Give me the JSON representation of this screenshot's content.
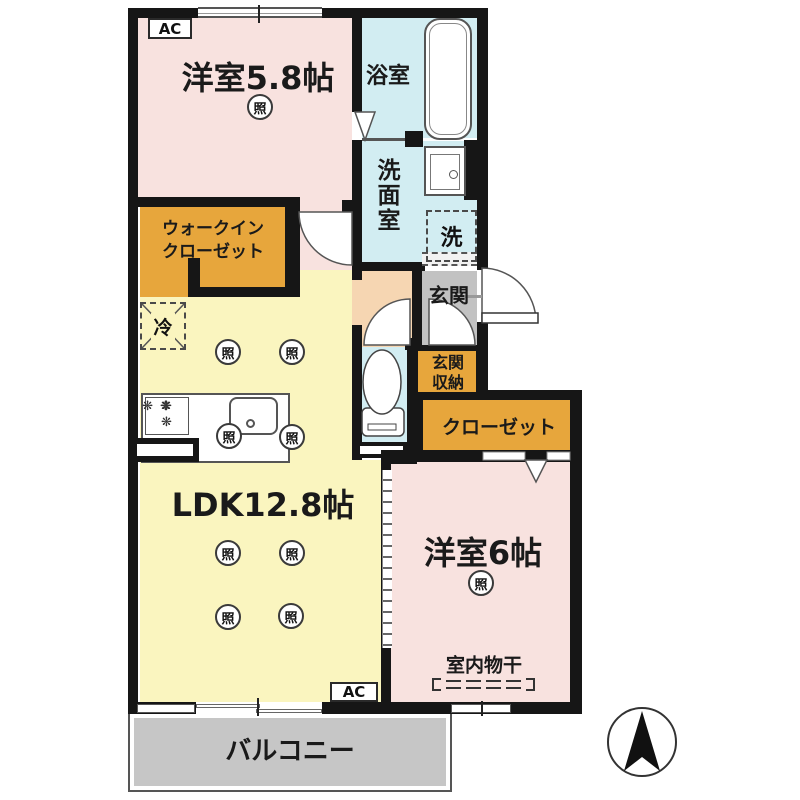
{
  "floorplan": {
    "rooms": {
      "bedroom1": {
        "label": "洋室5.8帖"
      },
      "bath": {
        "label": "浴室"
      },
      "washroom": {
        "label": "洗面室"
      },
      "entrance": {
        "label": "玄関"
      },
      "entrance_storage": {
        "line1": "玄関",
        "line2": "収納"
      },
      "closet": {
        "label": "クローゼット"
      },
      "walk_in_closet": {
        "line1": "ウォークイン",
        "line2": "クローゼット"
      },
      "ldk": {
        "label": "LDK12.8帖"
      },
      "bedroom2": {
        "label": "洋室6帖"
      },
      "balcony": {
        "label": "バルコニー"
      }
    },
    "symbols": {
      "ac": "AC",
      "light": "照",
      "fridge": "冷",
      "washer": "洗",
      "indoor_drying": "室内物干",
      "burner": "❋"
    },
    "colors": {
      "bedroom_pink": "#F8E2DF",
      "ldk_yellow": "#FAF5BF",
      "wet_area_cyan": "#D2EDF2",
      "hall_peach": "#F6D6B2",
      "entrance_gray": "#C2C2C2",
      "closet_orange": "#E7A63C",
      "balcony_gray": "#C6C6C6",
      "wall_black": "#161616"
    }
  }
}
